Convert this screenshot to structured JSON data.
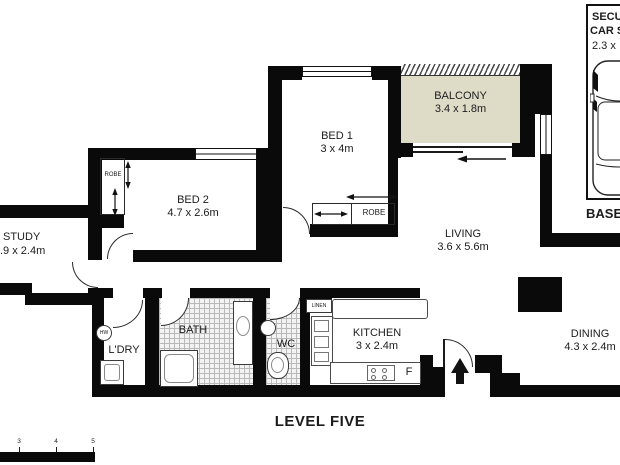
{
  "meta": {
    "level_label": "LEVEL FIVE"
  },
  "rooms": {
    "balcony": {
      "name": "BALCONY",
      "dims": "3.4 x 1.8m"
    },
    "bed1": {
      "name": "BED 1",
      "dims": "3 x 4m"
    },
    "bed2": {
      "name": "BED 2",
      "dims": "4.7 x 2.6m"
    },
    "study": {
      "name": "STUDY",
      "dims": ".9 x 2.4m"
    },
    "living": {
      "name": "LIVING",
      "dims": "3.6 x 5.6m"
    },
    "kitchen": {
      "name": "KITCHEN",
      "dims": "3 x 2.4m"
    },
    "dining": {
      "name": "DINING",
      "dims": "4.3 x 2.4m"
    },
    "bath": {
      "name": "BATH"
    },
    "wc": {
      "name": "WC"
    },
    "laundry": {
      "name": "L'DRY"
    },
    "linen": {
      "name": "LINEN"
    }
  },
  "labels": {
    "robe_bed1": "ROBE",
    "robe_bed2": "ROBE",
    "hot_water": "HW",
    "fridge": "F"
  },
  "car_space": {
    "line1": "SECU",
    "line2": "CAR S",
    "line3": "2.3 x",
    "caption": "BASE"
  },
  "scale_bar": {
    "ticks": [
      "3",
      "4",
      "5"
    ]
  },
  "colors": {
    "wall": "#0a0a0a",
    "balcony_fill": "#dedbc7"
  }
}
